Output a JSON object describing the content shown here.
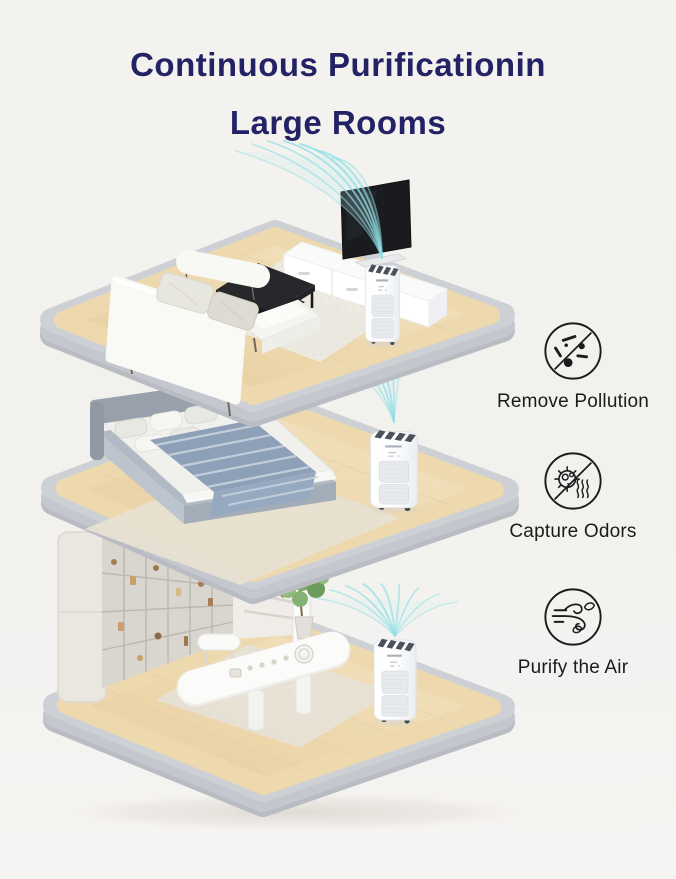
{
  "title": {
    "line1": "Continuous Purificationin",
    "line2": "Large Rooms"
  },
  "features": [
    {
      "label": "Remove Pollution",
      "icon": "remove-pollution-icon"
    },
    {
      "label": "Capture Odors",
      "icon": "capture-odors-icon"
    },
    {
      "label": "Purify the Air",
      "icon": "purify-the-air-icon"
    }
  ],
  "scenes": [
    {
      "name": "living-room",
      "objects": [
        "sofa",
        "sofa-bench",
        "coffee-table",
        "rug",
        "tv",
        "media-console",
        "air-purifier",
        "airflow"
      ]
    },
    {
      "name": "bedroom",
      "objects": [
        "bed",
        "headboard",
        "pillows",
        "striped-blanket",
        "rug",
        "air-purifier",
        "airflow"
      ]
    },
    {
      "name": "dining-room",
      "objects": [
        "storage-cabinet",
        "shelf-wall",
        "dining-table",
        "tea-set",
        "dining-chair",
        "potted-plant",
        "rug",
        "air-purifier",
        "airflow"
      ]
    }
  ],
  "colors": {
    "title_text": "#232264",
    "label_text": "#1b1b1b",
    "icon_stroke": "#1c1c1c",
    "airflow": "#8edee4",
    "wood_floor": "#ecd6ab",
    "platform_rim": "#cdd1d6",
    "background": "#f4f2ef"
  }
}
